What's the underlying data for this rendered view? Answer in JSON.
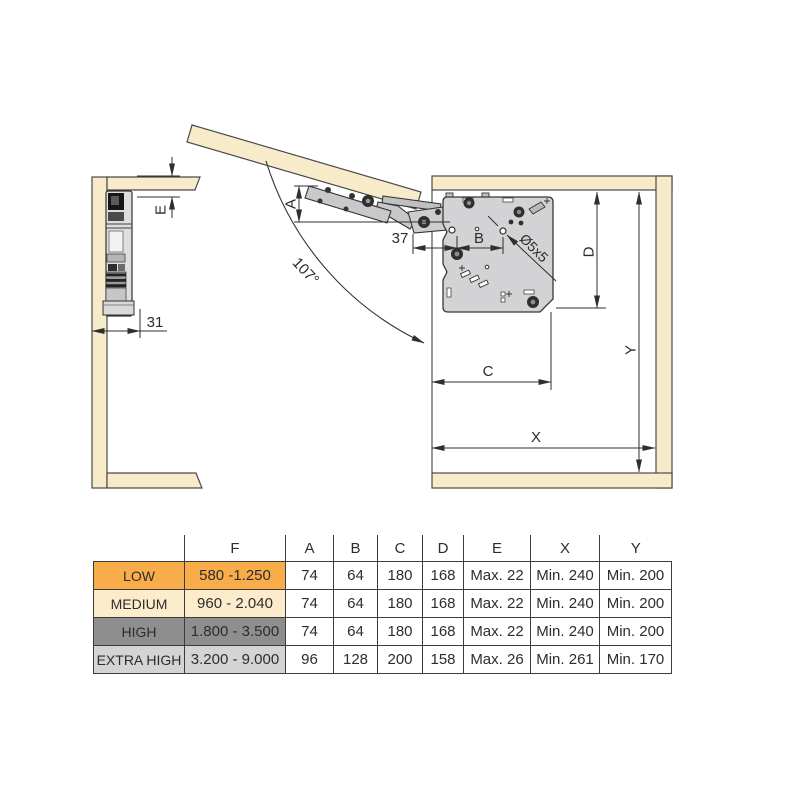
{
  "diagram": {
    "dimension_labels": {
      "a": "A",
      "b": "B",
      "c": "C",
      "d": "D",
      "e": "E",
      "x": "X",
      "y": "Y",
      "angle": "107°",
      "hole": "Ø5x5",
      "door_offset": "37",
      "side_offset": "31"
    },
    "colors": {
      "panel_beige": "#f7ebc9",
      "plate_gray": "#d3d3d5",
      "outline": "#2f2f2f"
    }
  },
  "table": {
    "headers": [
      "",
      "F",
      "A",
      "B",
      "C",
      "D",
      "E",
      "X",
      "Y"
    ],
    "rows": [
      {
        "key": "low",
        "color": "#f8ad4a",
        "cells": [
          "LOW",
          "580 -1.250",
          "74",
          "64",
          "180",
          "168",
          "Max. 22",
          "Min. 240",
          "Min. 200"
        ]
      },
      {
        "key": "medium",
        "color": "#fdeccb",
        "cells": [
          "MEDIUM",
          "960 - 2.040",
          "74",
          "64",
          "180",
          "168",
          "Max. 22",
          "Min. 240",
          "Min. 200"
        ]
      },
      {
        "key": "high",
        "color": "#8e8e8e",
        "cells": [
          "HIGH",
          "1.800 - 3.500",
          "74",
          "64",
          "180",
          "168",
          "Max. 22",
          "Min. 240",
          "Min. 200"
        ]
      },
      {
        "key": "extra_high",
        "color": "#d4d4d4",
        "cells": [
          "EXTRA HIGH",
          "3.200 - 9.000",
          "96",
          "128",
          "200",
          "158",
          "Max. 26",
          "Min. 261",
          "Min. 170"
        ]
      }
    ]
  }
}
